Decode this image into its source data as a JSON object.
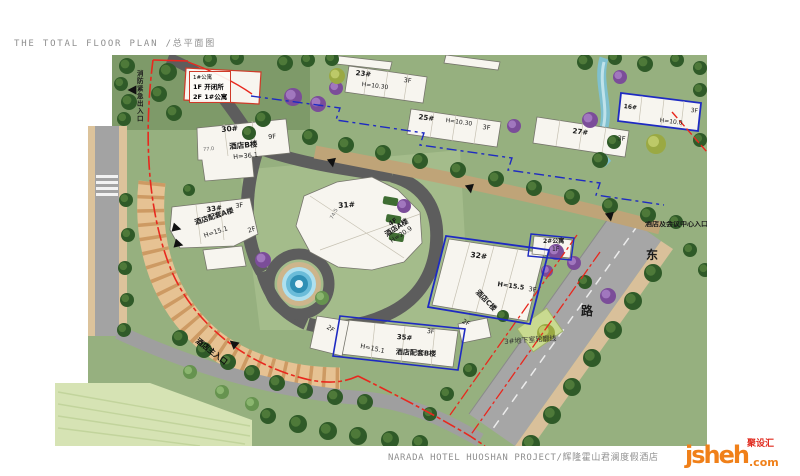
{
  "page": {
    "title": "THE TOTAL FLOOR PLAN /总平面图",
    "footer": "NARADA HOTEL HUOSHAN PROJECT/辉隆霍山君澜度假酒店",
    "watermark": {
      "logo": "jsheh",
      "tld": ".com",
      "badge": "聚设汇"
    }
  },
  "colors": {
    "boundary_red": "#e8281e",
    "parcel_blue": "#1e2ac2",
    "lawn_green": "#96b07f",
    "road_gray": "#a6a6a6",
    "promenade_tan": "#e6c293",
    "water_blue": "#2f8fb5",
    "title_gray": "#8f8f8f",
    "logo_orange": "#f08019",
    "badge_red": "#e02a1e"
  },
  "buildings": [
    {
      "id": "1#公寓",
      "line1": "1F 开闭所",
      "line2": "2F 1#公寓"
    },
    {
      "id": "30#",
      "floors": "9F",
      "name": "酒店B楼",
      "height": "H=36.1"
    },
    {
      "id": "31#",
      "floors": "4F",
      "name": "酒店A楼",
      "height": "H=20.9"
    },
    {
      "id": "32#",
      "floors": "3F",
      "name": "酒店C楼",
      "height": "H=15.5"
    },
    {
      "id": "33#",
      "floors": "3F",
      "name": "酒店配套A楼",
      "height": "H=15.1",
      "wing": "2F"
    },
    {
      "id": "35#",
      "floors": "3F",
      "name": "酒店配套B楼",
      "height": "H=15.1",
      "wing_left": "2F",
      "wing_right": "2F"
    },
    {
      "id": "23#",
      "floors": "3F",
      "height": "H=10.30"
    },
    {
      "id": "25#",
      "floors": "3F",
      "height": "H=10.30"
    },
    {
      "id": "27#",
      "floors": "3F"
    },
    {
      "id": "16#",
      "floors": "3F",
      "height": "H=10.0"
    },
    {
      "id": "2#公寓",
      "floors": "1F"
    }
  ],
  "annotations": {
    "fire_access": "消防紧急出入口",
    "hotel_main_entrance": "酒店主入口",
    "underground_outline": "3#地下室轮廓线",
    "conference_entrance": "酒店及会议中心入口",
    "road_east": "东",
    "road_lu": "路",
    "dim_30": "77.0",
    "dim_31": "74.5"
  }
}
